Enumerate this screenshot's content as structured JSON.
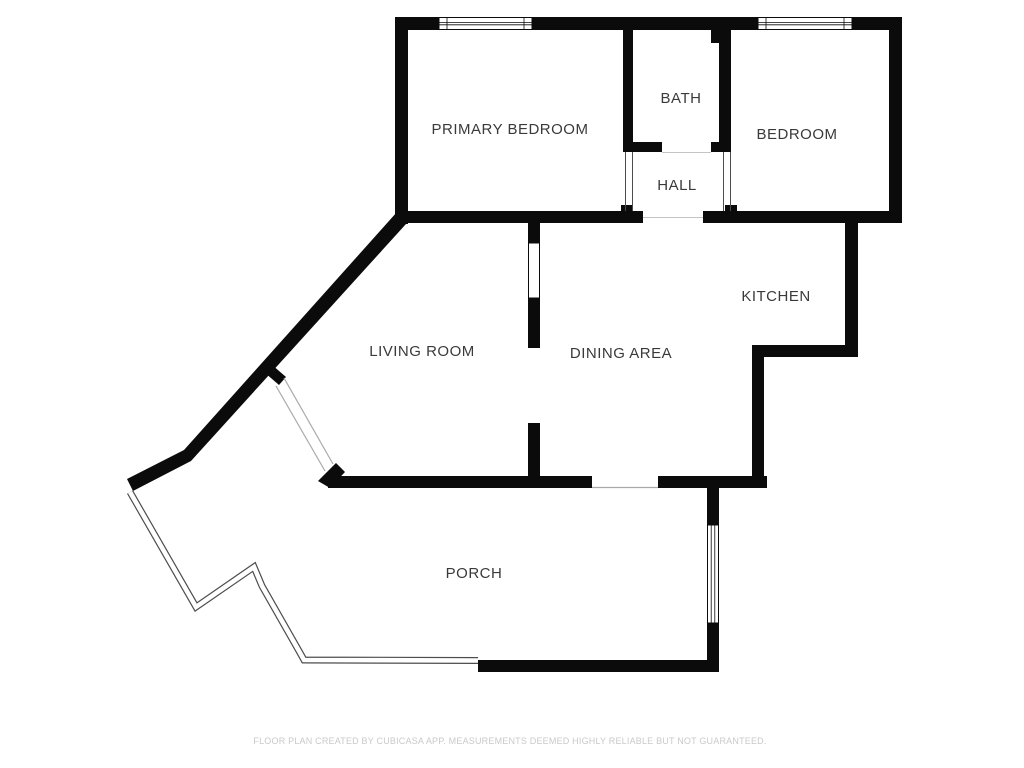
{
  "rooms": [
    {
      "id": "primary-bedroom",
      "label": "PRIMARY BEDROOM"
    },
    {
      "id": "bath",
      "label": "BATH"
    },
    {
      "id": "bedroom",
      "label": "BEDROOM"
    },
    {
      "id": "hall",
      "label": "HALL"
    },
    {
      "id": "kitchen",
      "label": "KITCHEN"
    },
    {
      "id": "living-room",
      "label": "LIVING ROOM"
    },
    {
      "id": "dining-area",
      "label": "DINING AREA"
    },
    {
      "id": "porch",
      "label": "PORCH"
    }
  ],
  "fixtures": {
    "windows": [
      "window-top-left",
      "window-top-right",
      "window-living-dining-passthrough",
      "window-porch-right"
    ],
    "openings": [
      "door-bath",
      "opening-hall-left",
      "opening-hall-right",
      "opening-hall-to-dining",
      "door-living-to-porch-diagonal",
      "door-dining-to-porch",
      "opening-living-dining"
    ]
  },
  "footer": {
    "disclaimer": "FLOOR PLAN CREATED BY CUBICASA APP. MEASUREMENTS DEEMED HIGHLY RELIABLE BUT NOT GUARANTEED."
  },
  "colors": {
    "wall": "#0b0b0b",
    "background": "#ffffff",
    "label": "#3a3a3a",
    "thin": "#4d4d4d",
    "door": "#a9a9a9",
    "faint": "#c4c4c4",
    "disclaimer": "#c9c9c9"
  }
}
